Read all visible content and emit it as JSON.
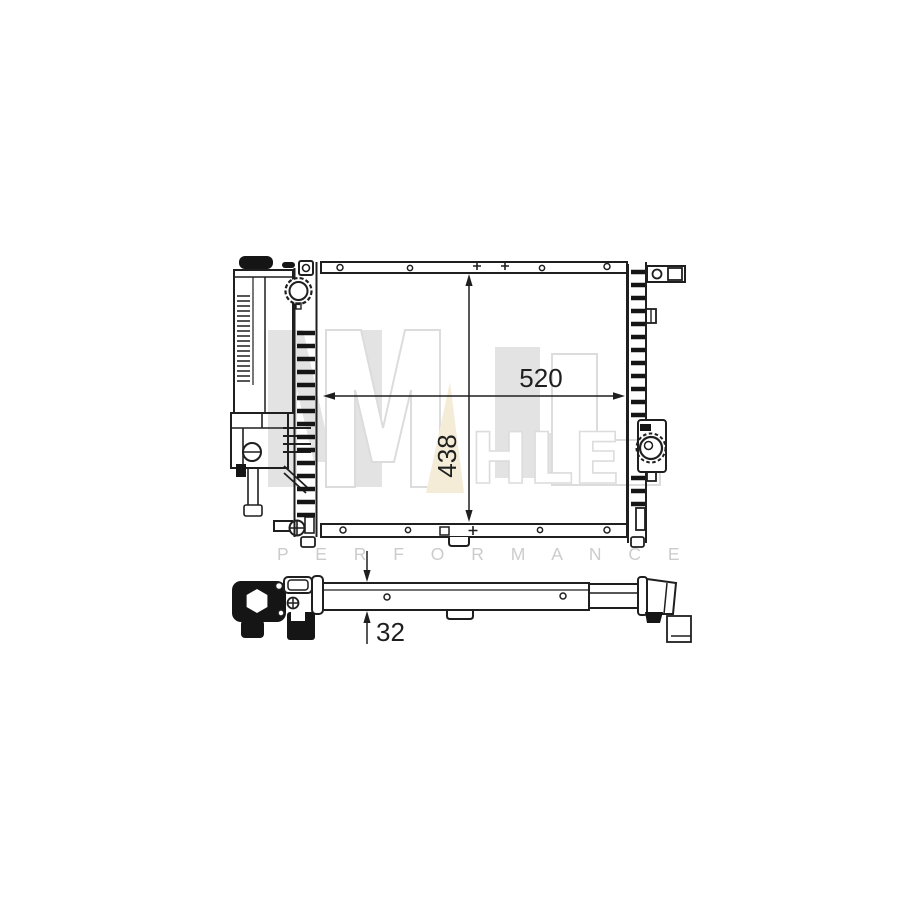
{
  "watermark": {
    "brand_word": "MAHLE",
    "monogram": "ML",
    "letters_small": "HLE",
    "subtitle": "P E R F O R M A N C E",
    "colors": {
      "gray": "#e3e3e3",
      "outline_gray": "#dcdcdc",
      "cream": "#f4ecd7",
      "subtitle_gray": "#cccccc"
    }
  },
  "dimensions": {
    "width_label": "520",
    "height_label": "438",
    "depth_label": "32"
  },
  "drawing": {
    "subject": "radiator technical drawing, front view and top view",
    "line_color": "#1f1f1f",
    "background": "#ffffff"
  }
}
